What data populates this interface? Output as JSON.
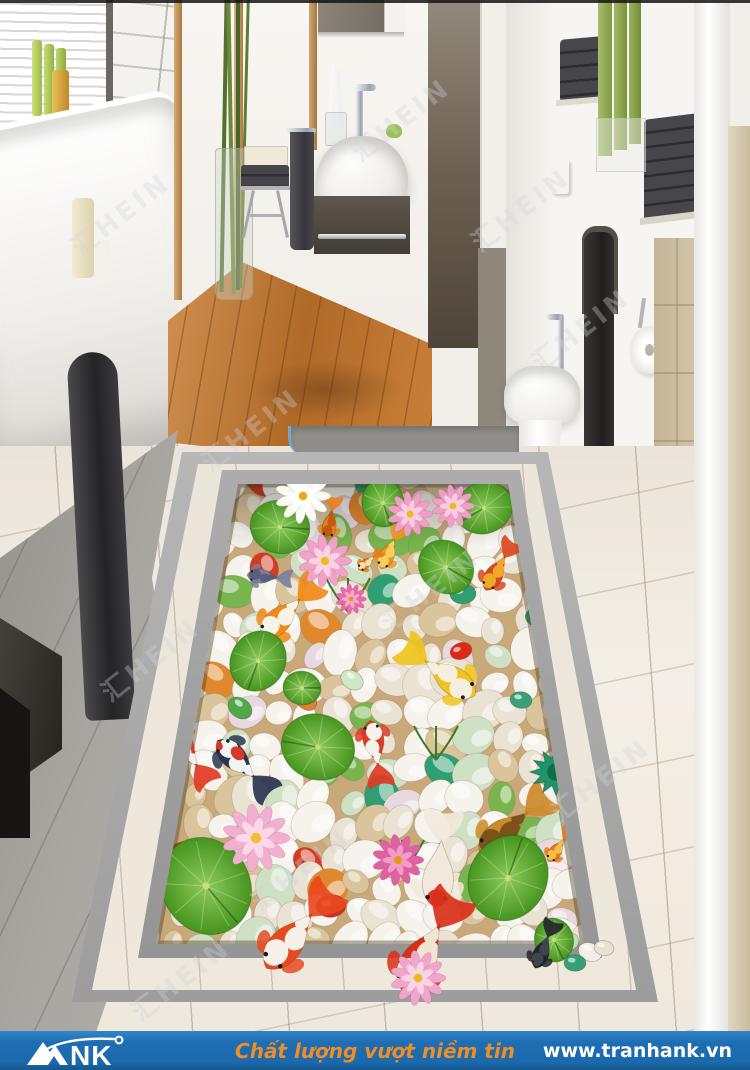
{
  "page": {
    "width": 750,
    "height": 1070,
    "kind": "3D floor mural advert photo"
  },
  "footer": {
    "bg": "#1e6db2",
    "logo_text": "ANK",
    "logo_nk": "NK",
    "tagline": "Chất lượng vượt niềm tin",
    "tagline_color": "#ef8d26",
    "website": "www.tranhank.vn",
    "text_color": "#ffffff"
  },
  "watermark": {
    "text": "汇HEIN",
    "color": "rgba(208,212,218,0.34)",
    "positions": [
      [
        120,
        215
      ],
      [
        400,
        120
      ],
      [
        250,
        430
      ],
      [
        580,
        330
      ],
      [
        150,
        660
      ],
      [
        430,
        590
      ],
      [
        300,
        870
      ],
      [
        600,
        780
      ],
      [
        180,
        980
      ],
      [
        520,
        210
      ]
    ]
  },
  "scene": {
    "description": "Bathroom with 3D koi pebble-pond floor mural",
    "mural": {
      "origin": [
        60,
        440
      ],
      "pond_clip": "178,44 448,44 524,504 96,504",
      "pond_base": "#c9a87a",
      "pebble_palette": [
        [
          "#f5f3ec",
          40
        ],
        [
          "#eae3d4",
          22
        ],
        [
          "#d9c49c",
          12
        ],
        [
          "#cfe0c4",
          8
        ],
        [
          "#e8d8e0",
          4
        ],
        [
          "#79b54e",
          5
        ],
        [
          "#2f9e72",
          3
        ],
        [
          "#d23c22",
          3
        ],
        [
          "#e0882e",
          3
        ]
      ],
      "pond_fish": [
        {
          "x": 331,
          "y": 517,
          "len": 44,
          "dir": 100,
          "main": "#e5821c",
          "patch": "#c05a10"
        },
        {
          "x": 391,
          "y": 547,
          "len": 48,
          "dir": 115,
          "main": "#ef9422",
          "patch": "#f6d05a"
        },
        {
          "x": 500,
          "y": 565,
          "len": 58,
          "dir": 120,
          "main": "#d8491e",
          "patch": "#f0a828"
        },
        {
          "x": 290,
          "y": 609,
          "len": 80,
          "dir": 135,
          "main": "#ef8a18",
          "patch": "#f8f3e8"
        },
        {
          "x": 438,
          "y": 670,
          "len": 90,
          "dir": 35,
          "main": "#eec41e",
          "patch": "#f6efe0"
        },
        {
          "x": 270,
          "y": 577,
          "len": 46,
          "dir": 185,
          "main": "#7b7f9e",
          "patch": "#5a5e7d"
        },
        {
          "x": 190,
          "y": 756,
          "len": 72,
          "dir": 235,
          "main": "#e03a24",
          "patch": "#f5f1e8"
        },
        {
          "x": 245,
          "y": 768,
          "len": 78,
          "dir": 225,
          "main": "#2b3550",
          "patch": "#f2f3f5",
          "patch2": "#d83828"
        },
        {
          "x": 376,
          "y": 754,
          "len": 68,
          "dir": 260,
          "main": "#de3b24",
          "patch": "#f6f3ee"
        },
        {
          "x": 515,
          "y": 823,
          "len": 92,
          "dir": 140,
          "main": "#cc8a28",
          "patch": "#7a521a"
        },
        {
          "x": 440,
          "y": 858,
          "len": 100,
          "dir": 95,
          "main": "#f2e9dc",
          "head": "#e03226"
        },
        {
          "x": 560,
          "y": 845,
          "len": 40,
          "dir": 125,
          "main": "#e87618",
          "patch": "#f2c048"
        },
        {
          "x": 370,
          "y": 560,
          "len": 30,
          "dir": 140,
          "main": "#e87d1a",
          "patch": "#f6e0b0"
        }
      ],
      "overflow_fish": [
        {
          "x": 300,
          "y": 928,
          "len": 105,
          "dir": 130,
          "main": "#e84a20",
          "patch": "#f6f1e8"
        },
        {
          "x": 430,
          "y": 942,
          "len": 112,
          "dir": 120,
          "main": "#d83018",
          "patch": "#efe5d2"
        },
        {
          "x": 545,
          "y": 944,
          "len": 52,
          "dir": 112,
          "main": "#23262b",
          "patch": "#40454d"
        }
      ],
      "lilypads": [
        {
          "x": 280,
          "y": 527,
          "r": 30,
          "rot": 15
        },
        {
          "x": 383,
          "y": 503,
          "r": 24,
          "rot": 80
        },
        {
          "x": 484,
          "y": 508,
          "r": 29,
          "rot": 160
        },
        {
          "x": 446,
          "y": 567,
          "r": 29,
          "rot": 40
        },
        {
          "x": 258,
          "y": 661,
          "r": 31,
          "rot": 120
        },
        {
          "x": 318,
          "y": 747,
          "r": 37,
          "rot": 200
        },
        {
          "x": 206,
          "y": 886,
          "r": 50,
          "rot": 60
        },
        {
          "x": 508,
          "y": 878,
          "r": 44,
          "rot": 300
        },
        {
          "x": 302,
          "y": 688,
          "r": 19,
          "rot": 10
        }
      ],
      "overflow_lilypads": [
        {
          "x": 554,
          "y": 940,
          "r": 22,
          "rot": 75
        }
      ],
      "pods": [
        {
          "x": 556,
          "y": 772,
          "r": 26,
          "c": "#1f9468"
        },
        {
          "x": 560,
          "y": 700,
          "r": 13,
          "c": "#2a9a70"
        }
      ],
      "flowers": [
        {
          "x": 303,
          "y": 496,
          "r": 27,
          "c": "#fbfaf4",
          "c2": "#ffffff",
          "center": "#e8a818",
          "stroke": "rgba(170,170,150,0.4)"
        },
        {
          "x": 410,
          "y": 514,
          "r": 22,
          "c": "#ef9ec6",
          "c2": "#f8cde2",
          "center": "#f0b820"
        },
        {
          "x": 453,
          "y": 506,
          "r": 21,
          "c": "#ef9ec6",
          "c2": "#f8cde2",
          "center": "#f0b820"
        },
        {
          "x": 325,
          "y": 561,
          "r": 26,
          "c": "#f0a2c8",
          "c2": "#f9d2e4",
          "center": "#f0b820"
        },
        {
          "x": 351,
          "y": 599,
          "r": 15,
          "c": "#e86aa8",
          "c2": "#f4a8cc",
          "center": "#e89810"
        },
        {
          "x": 256,
          "y": 838,
          "r": 33,
          "c": "#f2b0d0",
          "c2": "#fad8e8",
          "center": "#f0c030"
        },
        {
          "x": 398,
          "y": 860,
          "r": 25,
          "c": "#e060a4",
          "c2": "#f09cc6",
          "center": "#e89810"
        }
      ],
      "overflow_flowers": [
        {
          "x": 418,
          "y": 978,
          "r": 27,
          "c": "#f0a6ca",
          "c2": "#f9d4e6",
          "center": "#f0b820"
        }
      ],
      "accent_pebbles": [
        {
          "x": 461,
          "y": 651,
          "r": 11,
          "c": "#e02818"
        },
        {
          "x": 331,
          "y": 906,
          "r": 15,
          "c": "#d03020"
        },
        {
          "x": 463,
          "y": 594,
          "r": 13,
          "c": "#2f9e72"
        },
        {
          "x": 306,
          "y": 700,
          "r": 12,
          "c": "#e08030"
        },
        {
          "x": 521,
          "y": 700,
          "r": 11,
          "c": "#38a078"
        },
        {
          "x": 240,
          "y": 708,
          "r": 13,
          "c": "#50a84a"
        },
        {
          "x": 537,
          "y": 618,
          "r": 12,
          "c": "#2f9e72"
        },
        {
          "x": 352,
          "y": 680,
          "r": 12,
          "c": "#cfe7c8"
        }
      ],
      "overflow_pebbles": [
        {
          "x": 566,
          "y": 942,
          "r": 13,
          "c": "#bfe0c0"
        },
        {
          "x": 590,
          "y": 952,
          "r": 12,
          "c": "#f2efe8"
        },
        {
          "x": 575,
          "y": 963,
          "r": 11,
          "c": "#35a077"
        },
        {
          "x": 604,
          "y": 948,
          "r": 10,
          "c": "#e8e2d2"
        }
      ],
      "grass": [
        [
          348,
          612
        ],
        [
          402,
          874
        ],
        [
          436,
          760
        ]
      ]
    }
  }
}
